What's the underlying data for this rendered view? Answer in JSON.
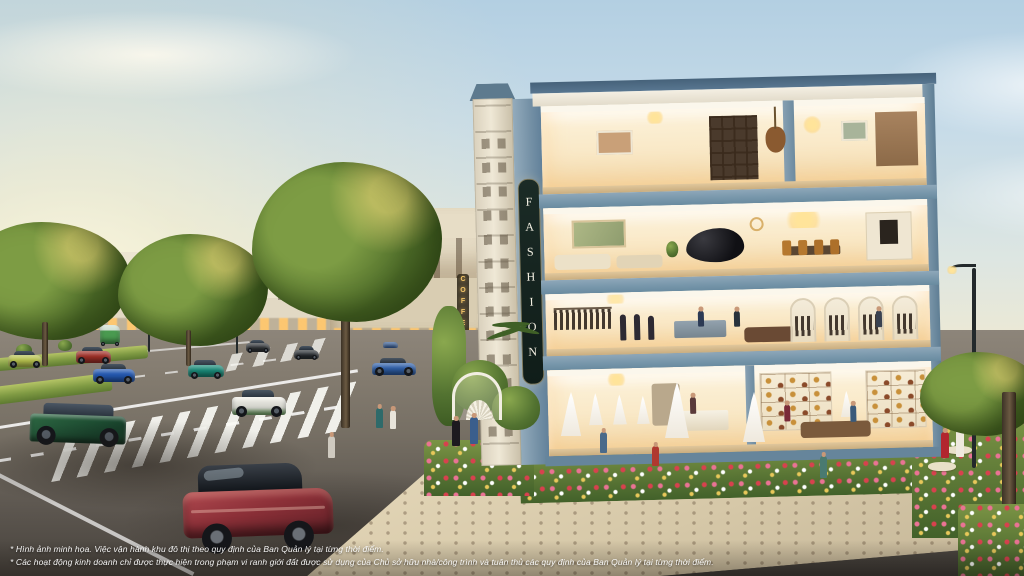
{
  "scene": {
    "name": "sunset-boulevard-shophouse-render",
    "description": "Architectural marketing rendering at sunset: a four-storey corner shophouse with illuminated cutaway interiors (bridal and handbag boutiques, menswear atelier, piano lounge and dining room, penthouse living floor) beside a tree-lined boulevard with cars, crosswalks, gardens and pedestrians."
  },
  "building": {
    "sign_vertical": "FASHION",
    "floors": [
      {
        "level": 4,
        "use": "penthouse living floor"
      },
      {
        "level": 3,
        "use": "piano lounge and dining room"
      },
      {
        "level": 2,
        "use": "menswear boutique"
      },
      {
        "level": 1,
        "use": "bridal shop and handbag boutique"
      }
    ]
  },
  "street": {
    "cafe_sign_vertical": "COFFEE"
  },
  "disclaimer": {
    "line1": "* Hình ảnh minh họa. Việc vận hành khu đô thị theo quy định của Ban Quản lý tại từng thời điểm.",
    "line2": "* Các hoạt động kinh doanh chỉ được thực hiện trong phạm vi ranh giới đất được sử dụng của Chủ sở hữu nhà/công trình và tuân thủ các quy định của Ban Quản lý tại từng thời điểm."
  },
  "colors": {
    "sky_top": "#b3cfe2",
    "horizon_glow": "#f9efcf",
    "building_trim_blue": "#7897ab",
    "interior_glow": "#fdf4de",
    "sign_background": "#15231f",
    "sign_letters": "#f3efe2",
    "foliage_green": "#5d7c33",
    "flower_pink": "#ea7394",
    "grass_median": "#7f9a43",
    "foreground_suv_red": "#8c3038",
    "road_gray": "#766f64"
  }
}
